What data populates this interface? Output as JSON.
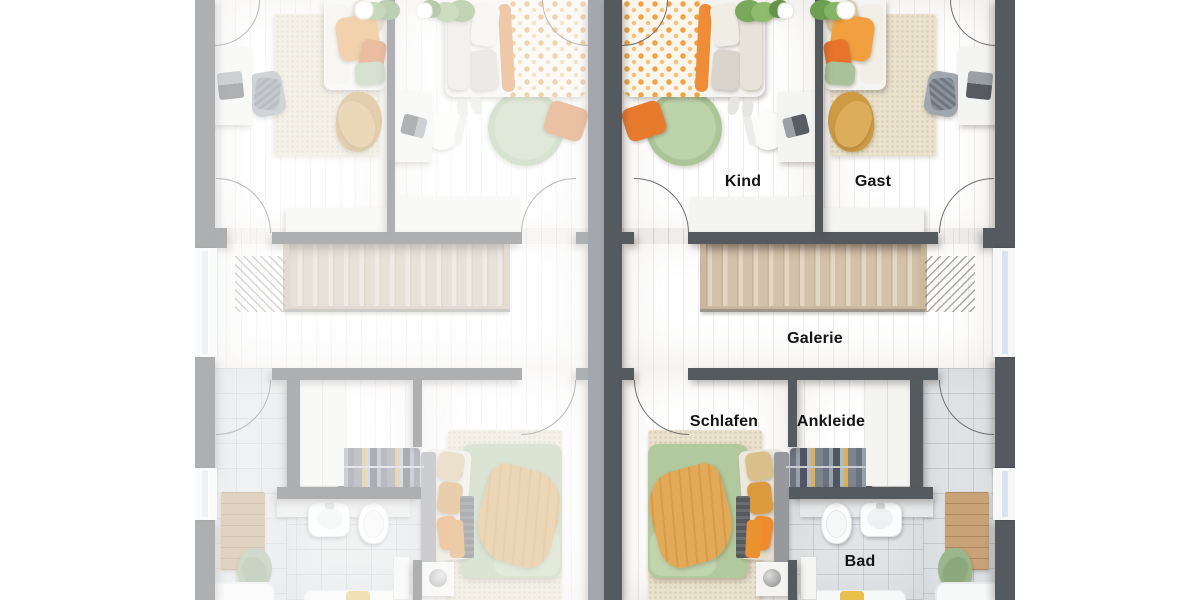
{
  "scene": {
    "type": "architectural-floor-plan",
    "description": "Top-down 3D rendered upper-floor plan of a semi-detached duplex; right unit rendered in full colour with German room labels, left unit is a faded mirror image",
    "background": "#ffffff"
  },
  "floor_plan": {
    "room_labels": [
      {
        "id": "kind",
        "text": "Kind"
      },
      {
        "id": "gast",
        "text": "Gast"
      },
      {
        "id": "galerie",
        "text": "Galerie"
      },
      {
        "id": "schlafen",
        "text": "Schlafen"
      },
      {
        "id": "ankleide",
        "text": "Ankleide"
      },
      {
        "id": "bad",
        "text": "Bad"
      }
    ],
    "units": [
      {
        "side": "left",
        "appearance": "faded mirror copy",
        "labeled": false
      },
      {
        "side": "right",
        "appearance": "full colour",
        "labeled": true
      }
    ],
    "fixtures": {
      "kind": [
        "bed-floral-duvet",
        "round-green-rug",
        "orange-floor-cushion",
        "desk",
        "chair",
        "sideboard",
        "plant"
      ],
      "gast": [
        "bed-orange-pillows",
        "cream-rug",
        "blanket",
        "lounge-chair",
        "desk",
        "sideboard",
        "plant"
      ],
      "galerie": [
        "staircase",
        "railing"
      ],
      "schlafen": [
        "double-bed-green-orange",
        "cream-rug",
        "nightstand-with-lamp",
        "bench"
      ],
      "ankleide": [
        "clothes-rail",
        "wardrobe"
      ],
      "bad": [
        "vanity",
        "wall-hung-toilet",
        "bidet",
        "bathtub",
        "wooden-mat",
        "green-towel"
      ]
    },
    "colors": {
      "wall_dark": "#555a5f",
      "wall_faded": "#a4a7ab",
      "floor_wood_cool": "#d5c8ba",
      "floor_wood_warm": "#d3c0a9",
      "bathroom_tile": "#e1e4e6",
      "rug_cream": "#eae2cd",
      "rug_green": "#b7cfa3",
      "accent_orange": "#ef8c35",
      "accent_soft_orange": "#f2a03f",
      "accent_green": "#b2c99e",
      "furniture_white": "#f4f4f2",
      "window_glass": "#d7e6ee",
      "label_text": "#141414"
    }
  }
}
